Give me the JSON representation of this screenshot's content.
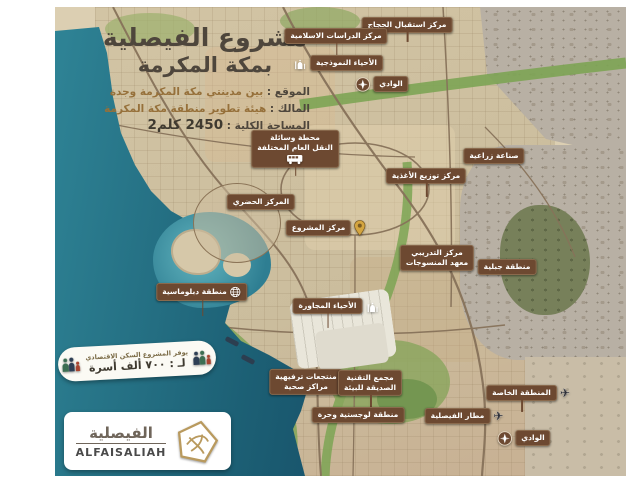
{
  "header": {
    "title_line1": "مشروع الفيصلية",
    "title_line2": "بمكة المكرمة",
    "info": [
      {
        "label": "الموقع :",
        "value": "بين مدينتي مكة المكرمة وجدة"
      },
      {
        "label": "المالك :",
        "value": "هيئة تطوير منطقة مكة المكرمة"
      },
      {
        "label": "المساحة الكلية :",
        "value": "2450 كلم2"
      }
    ]
  },
  "housing_badge": {
    "line1": "يوفر المشروع السكن الاقتصادي",
    "line2": "لـ : ٧٠٠ ألف أسرة"
  },
  "logo": {
    "arabic": "الفيصلية",
    "latin": "ALFAISALIAH"
  },
  "map_labels": [
    {
      "id": "hajj-reception-center",
      "text": "مركز استقبال الحجاج",
      "x": 407,
      "y": 25,
      "stem": 10
    },
    {
      "id": "islamic-studies-center",
      "text": "مركز الدراسات الاسلامية",
      "x": 336,
      "y": 36,
      "stem": 12
    },
    {
      "id": "model-districts",
      "text": "الأحياء النموذجية",
      "x": 338,
      "y": 63,
      "icon": "mosque",
      "icon_side": "left"
    },
    {
      "id": "wadi-north",
      "text": "الوادي",
      "x": 382,
      "y": 84,
      "icon": "compass",
      "icon_side": "left"
    },
    {
      "id": "public-transport-station",
      "text": "محطة وسائلة\nالنقل العام المختلفة",
      "x": 295,
      "y": 149,
      "icon": "bus",
      "icon_side": "bottom",
      "stem": 9
    },
    {
      "id": "agricultural-industry",
      "text": "صناعة زراعية",
      "x": 494,
      "y": 156
    },
    {
      "id": "food-distribution-center",
      "text": "مركز توزيع الأغذية",
      "x": 426,
      "y": 176,
      "stem": 14
    },
    {
      "id": "urban-center",
      "text": "المركز الحضري",
      "x": 261,
      "y": 202
    },
    {
      "id": "project-center",
      "text": "مركز المشروع",
      "x": 326,
      "y": 228,
      "icon": "pin",
      "icon_side": "right"
    },
    {
      "id": "textile-institute-training-center",
      "text": "مركز التدريبي\nمعهد المنسوجات",
      "x": 437,
      "y": 258
    },
    {
      "id": "mountain-area",
      "text": "منطقة جبلية",
      "x": 507,
      "y": 267
    },
    {
      "id": "diplomatic-area",
      "text": "منطقة دبلوماسية",
      "x": 202,
      "y": 292,
      "icon": "globe",
      "icon_side": "in-left",
      "stem": 16
    },
    {
      "id": "neighboring-districts",
      "text": "الأحياء المجاورة",
      "x": 336,
      "y": 306,
      "icon": "mosque",
      "icon_side": "right",
      "stem": 15
    },
    {
      "id": "resorts-health-centers",
      "text": "منتجعات ترفيهية\nمراكز صحية",
      "x": 306,
      "y": 382
    },
    {
      "id": "eco-friendly-tech-complex",
      "text": "مجمع التقنية\nالصديقة للبيئة",
      "x": 370,
      "y": 383,
      "stem": 22
    },
    {
      "id": "special-zone",
      "text": "المنطقة الخاصة",
      "x": 528,
      "y": 393,
      "icon": "plane",
      "icon_side": "right",
      "stem": 12
    },
    {
      "id": "logistics-free-zone",
      "text": "منطقة لوجستية وحرة",
      "x": 358,
      "y": 415
    },
    {
      "id": "faisaliah-airport",
      "text": "مطار الفيصلية",
      "x": 464,
      "y": 416,
      "icon": "plane",
      "icon_side": "right"
    },
    {
      "id": "wadi-south",
      "text": "الوادي",
      "x": 524,
      "y": 438,
      "icon": "compass",
      "icon_side": "left"
    }
  ],
  "colors": {
    "tag_bg": "#6d4931",
    "sea": "#1c5f74",
    "accent_gold": "#96703a"
  }
}
